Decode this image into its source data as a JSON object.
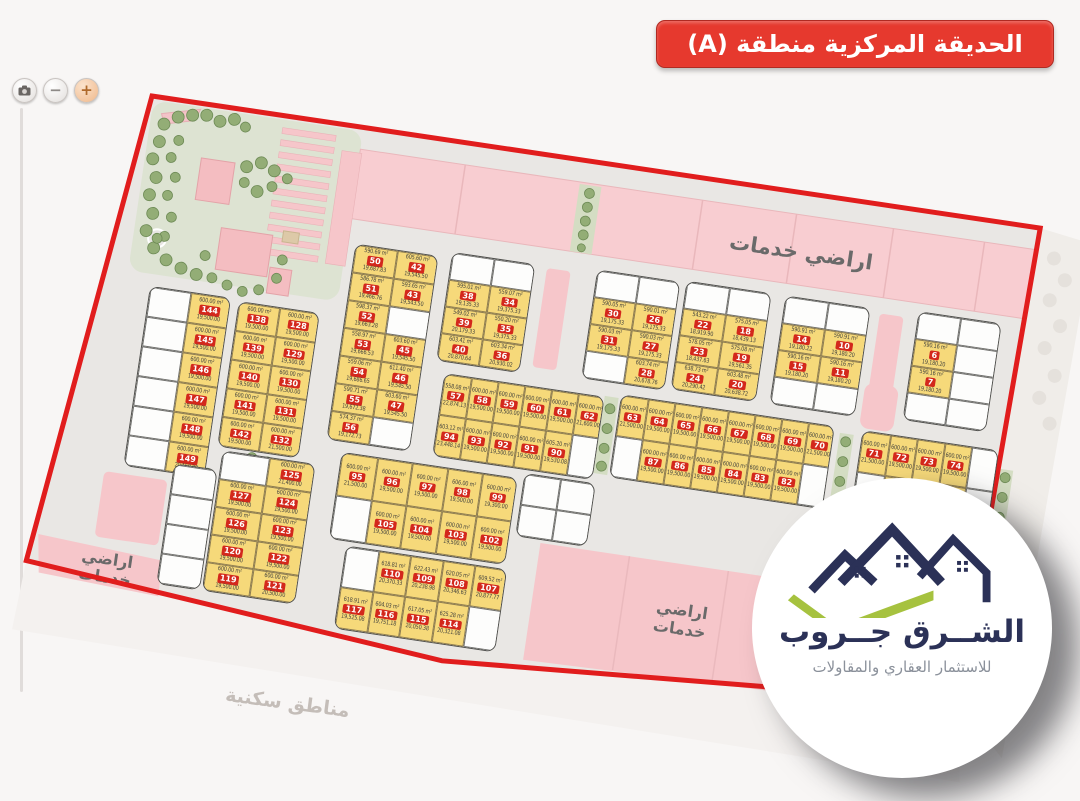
{
  "banner": {
    "text": "الحديقة المركزية منطقة (A)"
  },
  "controls": {
    "camera_icon": "camera-icon",
    "zoom_out_label": "−",
    "zoom_in_label": "+"
  },
  "labels": {
    "services_top": "اراضي خدمات",
    "services_lines": [
      "اراضي",
      "خدمات"
    ],
    "residential": "مناطق سكنية"
  },
  "logo": {
    "title": "الشــرق جــروب",
    "subtitle": "للاستثمار العقاري والمقاولات"
  },
  "colors": {
    "banner_red": "#e6392e",
    "boundary_red": "#e11d1d",
    "plot_yellow": "#f6d97a",
    "badge_red": "#d3281c",
    "service_pink": "#f7c4c9",
    "logo_navy": "#2b3157",
    "logo_green": "#a6c23f"
  },
  "plots": {
    "default_area": "600.00 m²",
    "default_price": "19,500.00",
    "blocks": [
      {
        "id": "L1",
        "rows": [
          [
            null,
            {
              "n": "144"
            }
          ],
          [
            null,
            {
              "n": "145"
            }
          ],
          [
            null,
            {
              "n": "146"
            }
          ],
          [
            null,
            {
              "n": "147"
            }
          ],
          [
            null,
            {
              "n": "148"
            }
          ],
          [
            null,
            {
              "n": "149",
              "p": "20,150.00"
            }
          ]
        ]
      },
      {
        "id": "L2",
        "rows": [
          [
            {
              "n": "138"
            },
            {
              "n": "128"
            }
          ],
          [
            {
              "n": "139"
            },
            {
              "n": "129"
            }
          ],
          [
            {
              "n": "140"
            },
            {
              "n": "130"
            }
          ],
          [
            {
              "n": "141"
            },
            {
              "n": "131"
            }
          ],
          [
            {
              "n": "142"
            },
            {
              "n": "132",
              "p": "21,500.00"
            }
          ]
        ]
      },
      {
        "id": "L3",
        "rows": [
          [
            null,
            {
              "n": "125",
              "p": "21,400.00"
            }
          ],
          [
            {
              "n": "127"
            },
            {
              "n": "124"
            }
          ],
          [
            {
              "n": "126"
            },
            {
              "n": "123"
            }
          ],
          [
            {
              "n": "120"
            },
            {
              "n": "122"
            }
          ],
          [
            {
              "n": "119"
            },
            {
              "n": "121",
              "p": "20,500.00"
            }
          ]
        ]
      },
      {
        "id": "M1",
        "rows": [
          [
            {
              "n": "50",
              "a": "590.69 m²",
              "p": "19,687.83"
            },
            {
              "n": "42",
              "a": "605.60 m²",
              "p": "19,545.50"
            }
          ],
          [
            {
              "n": "51",
              "a": "586.78 m²",
              "p": "19,466.76"
            },
            {
              "n": "43",
              "a": "593.65 m²",
              "p": "19,543.50"
            }
          ],
          [
            {
              "n": "52",
              "a": "598.37 m²",
              "p": "19,663.28"
            },
            null
          ],
          [
            {
              "n": "53",
              "a": "558.97 m²",
              "p": "19,666.53"
            },
            {
              "n": "45",
              "a": "603.60 m²",
              "p": "19,545.50"
            }
          ],
          [
            {
              "n": "54",
              "a": "559.06 m²",
              "p": "19,686.65"
            },
            {
              "n": "46",
              "a": "611.40 m²",
              "p": "19,545.50"
            }
          ],
          [
            {
              "n": "55",
              "a": "590.71 m²",
              "p": "19,672.38"
            },
            {
              "n": "47",
              "a": "603.60 m²",
              "p": "19,545.50"
            }
          ],
          [
            {
              "n": "56",
              "a": "574.37 m²",
              "p": "19,172.73"
            },
            null
          ]
        ]
      },
      {
        "id": "U2",
        "rows": [
          [
            null,
            null
          ],
          [
            {
              "n": "38",
              "a": "595.01 m²",
              "p": "19,135.33"
            },
            {
              "n": "34",
              "a": "559.07 m²",
              "p": "19,375.33"
            }
          ],
          [
            {
              "n": "39",
              "a": "549.02 m²",
              "p": "20,179.33"
            },
            {
              "n": "35",
              "a": "550.20 m²",
              "p": "19,375.33"
            }
          ],
          [
            {
              "n": "40",
              "a": "603.41 m²",
              "p": "20,870.64"
            },
            {
              "n": "36",
              "a": "603.34 m²",
              "p": "20,930.02"
            }
          ]
        ]
      },
      {
        "id": "U3",
        "rows": [
          [
            null,
            null
          ],
          [
            {
              "n": "30",
              "a": "590.05 m²",
              "p": "19,175.33"
            },
            {
              "n": "26",
              "a": "590.01 m²",
              "p": "19,175.33"
            }
          ],
          [
            {
              "n": "31",
              "a": "590.03 m²",
              "p": "19,175.33"
            },
            {
              "n": "27",
              "a": "590.03 m²",
              "p": "19,175.33"
            }
          ],
          [
            null,
            {
              "n": "28",
              "a": "603.74 m²",
              "p": "20,678.76"
            }
          ]
        ]
      },
      {
        "id": "U4",
        "rows": [
          [
            null,
            null
          ],
          [
            {
              "n": "22",
              "a": "543.22 m²",
              "p": "18,919.90"
            },
            {
              "n": "18",
              "a": "575.05 m²",
              "p": "18,439.13"
            }
          ],
          [
            {
              "n": "23",
              "a": "578.05 m²",
              "p": "18,437.63"
            },
            {
              "n": "19",
              "a": "575.08 m²",
              "p": "19,561.35"
            }
          ],
          [
            {
              "n": "24",
              "a": "638.73 m²",
              "p": "20,290.42"
            },
            {
              "n": "20",
              "a": "603.48 m²",
              "p": "20,638.72"
            }
          ]
        ]
      },
      {
        "id": "U5",
        "rows": [
          [
            null,
            null
          ],
          [
            {
              "n": "14",
              "a": "590.91 m²",
              "p": "19,180.22"
            },
            {
              "n": "10",
              "a": "590.91 m²",
              "p": "19,180.20"
            }
          ],
          [
            {
              "n": "15",
              "a": "590.16 m²",
              "p": "19,180.20"
            },
            {
              "n": "11",
              "a": "590.16 m²",
              "p": "19,180.20"
            }
          ],
          [
            null,
            null
          ]
        ]
      },
      {
        "id": "U6",
        "rows": [
          [
            null,
            null
          ],
          [
            {
              "n": "6",
              "a": "590.16 m²",
              "p": "19,180.20"
            },
            null
          ],
          [
            {
              "n": "7",
              "a": "590.16 m²",
              "p": "19,180.20"
            },
            null
          ],
          [
            null,
            null
          ]
        ]
      },
      {
        "id": "C1",
        "rows": [
          [
            {
              "n": "57",
              "a": "558.08 m²",
              "p": "22,874.13"
            },
            {
              "n": "58"
            },
            {
              "n": "59"
            },
            {
              "n": "60"
            },
            {
              "n": "61"
            },
            {
              "n": "62",
              "p": "21,600.00"
            }
          ],
          [
            {
              "n": "94",
              "a": "603.12 m²",
              "p": "23,448.14"
            },
            {
              "n": "93"
            },
            {
              "n": "92"
            },
            {
              "n": "91"
            },
            {
              "n": "90",
              "a": "605.20 m²",
              "p": "19,530.08"
            },
            null
          ]
        ]
      },
      {
        "id": "C2",
        "rows": [
          [
            {
              "n": "63",
              "p": "21,500.00"
            },
            {
              "n": "64"
            },
            {
              "n": "65"
            },
            {
              "n": "66"
            },
            {
              "n": "67"
            },
            {
              "n": "68"
            },
            {
              "n": "69"
            },
            {
              "n": "70",
              "p": "21,500.00"
            }
          ],
          [
            null,
            {
              "n": "87"
            },
            {
              "n": "86"
            },
            {
              "n": "85"
            },
            {
              "n": "84"
            },
            {
              "n": "83"
            },
            {
              "n": "82"
            },
            null
          ]
        ]
      },
      {
        "id": "C3",
        "rows": [
          [
            {
              "n": "71",
              "p": "21,500.00"
            },
            {
              "n": "72"
            },
            {
              "n": "73"
            },
            {
              "n": "74"
            },
            null
          ],
          [
            null,
            {
              "n": "79"
            },
            {
              "n": "78"
            },
            {
              "n": "77"
            },
            null
          ]
        ]
      },
      {
        "id": "D1",
        "rows": [
          [
            {
              "n": "95",
              "p": "21,500.00"
            },
            {
              "n": "96"
            },
            {
              "n": "97"
            },
            {
              "n": "98",
              "a": "606.00 m²"
            },
            {
              "n": "99",
              "p": "19,300.00"
            }
          ],
          [
            null,
            {
              "n": "105"
            },
            {
              "n": "104"
            },
            {
              "n": "103"
            },
            {
              "n": "102"
            }
          ]
        ]
      },
      {
        "id": "D2",
        "rows": [
          [
            null,
            {
              "n": "110",
              "a": "618.81 m²",
              "p": "20,370.33"
            },
            {
              "n": "109",
              "a": "622.43 m²",
              "p": "20,238.98"
            },
            {
              "n": "108",
              "a": "620.05 m²",
              "p": "20,346.63"
            },
            {
              "n": "107",
              "a": "609.52 m²",
              "p": "20,877.77"
            }
          ],
          [
            {
              "n": "117",
              "a": "618.91 m²",
              "p": "19,525.08"
            },
            {
              "n": "116",
              "a": "604.03 m²",
              "p": "19,751.18"
            },
            {
              "n": "115",
              "a": "617.05 m²",
              "p": "20,050.38"
            },
            {
              "n": "114",
              "a": "625.28 m²",
              "p": "20,321.08"
            },
            null
          ]
        ]
      },
      {
        "id": "W1",
        "rows": [
          [
            null
          ],
          [
            null
          ],
          [
            null
          ],
          [
            null
          ]
        ]
      },
      {
        "id": "W3",
        "rows": [
          [
            null,
            null
          ],
          [
            null,
            null
          ]
        ]
      }
    ]
  }
}
